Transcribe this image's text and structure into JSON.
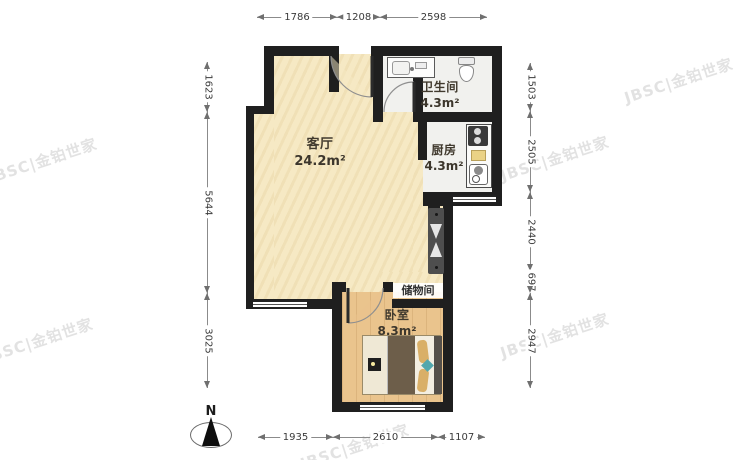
{
  "plan": {
    "rooms": [
      {
        "id": "living",
        "name": "客厅",
        "area": "24.2m²"
      },
      {
        "id": "bathroom",
        "name": "卫生间",
        "area": "4.3m²"
      },
      {
        "id": "kitchen",
        "name": "厨房",
        "area": "4.3m²"
      },
      {
        "id": "bedroom",
        "name": "卧室",
        "area": "8.3m²"
      },
      {
        "id": "storage",
        "name": "储物间",
        "area": ""
      }
    ],
    "dimensions": {
      "top": [
        "1786",
        "1208",
        "2598"
      ],
      "bottom": [
        "1935",
        "2610",
        "1107"
      ],
      "left": [
        "1623",
        "5644",
        "3025"
      ],
      "right": [
        "1503",
        "2505",
        "2440",
        "697",
        "2947"
      ]
    },
    "north_label": "N",
    "watermark": "JBSC|金铂世家",
    "colors": {
      "wall": "#1f1f1f",
      "floor_living": "#f6e9c4",
      "floor_wood": "#eac48d",
      "floor_tile": "#f1f1ee",
      "shaft": "#4e4e4e"
    }
  }
}
